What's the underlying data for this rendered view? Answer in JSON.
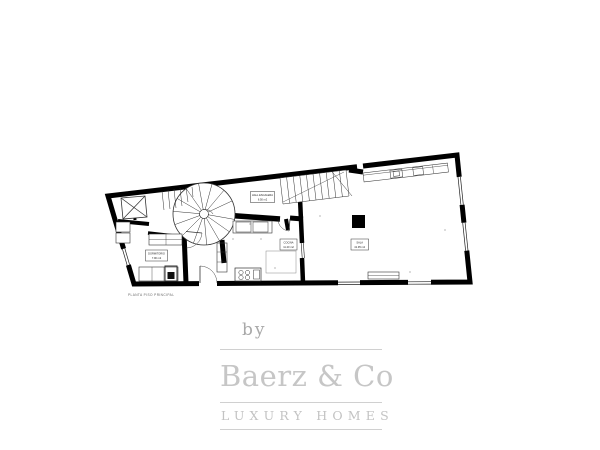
{
  "watermark": {
    "by_label": "by",
    "brand_name": "Baerz & Co",
    "tagline": "LUXURY HOMES",
    "gray_color": "#c6c6c6"
  },
  "floor_plan": {
    "caption": "PLANTA PISO PRINCIPAL",
    "wall_color": "#000000",
    "line_color": "#333333",
    "labels": [
      {
        "name": "HALL ESCALERA",
        "area": "6.50 m2"
      },
      {
        "name": "COCINA",
        "area": "11.20 m2"
      },
      {
        "name": "SALA",
        "area": "41.95 m2"
      },
      {
        "name": "DORMITORIO",
        "area": "7.90 m2"
      }
    ]
  }
}
